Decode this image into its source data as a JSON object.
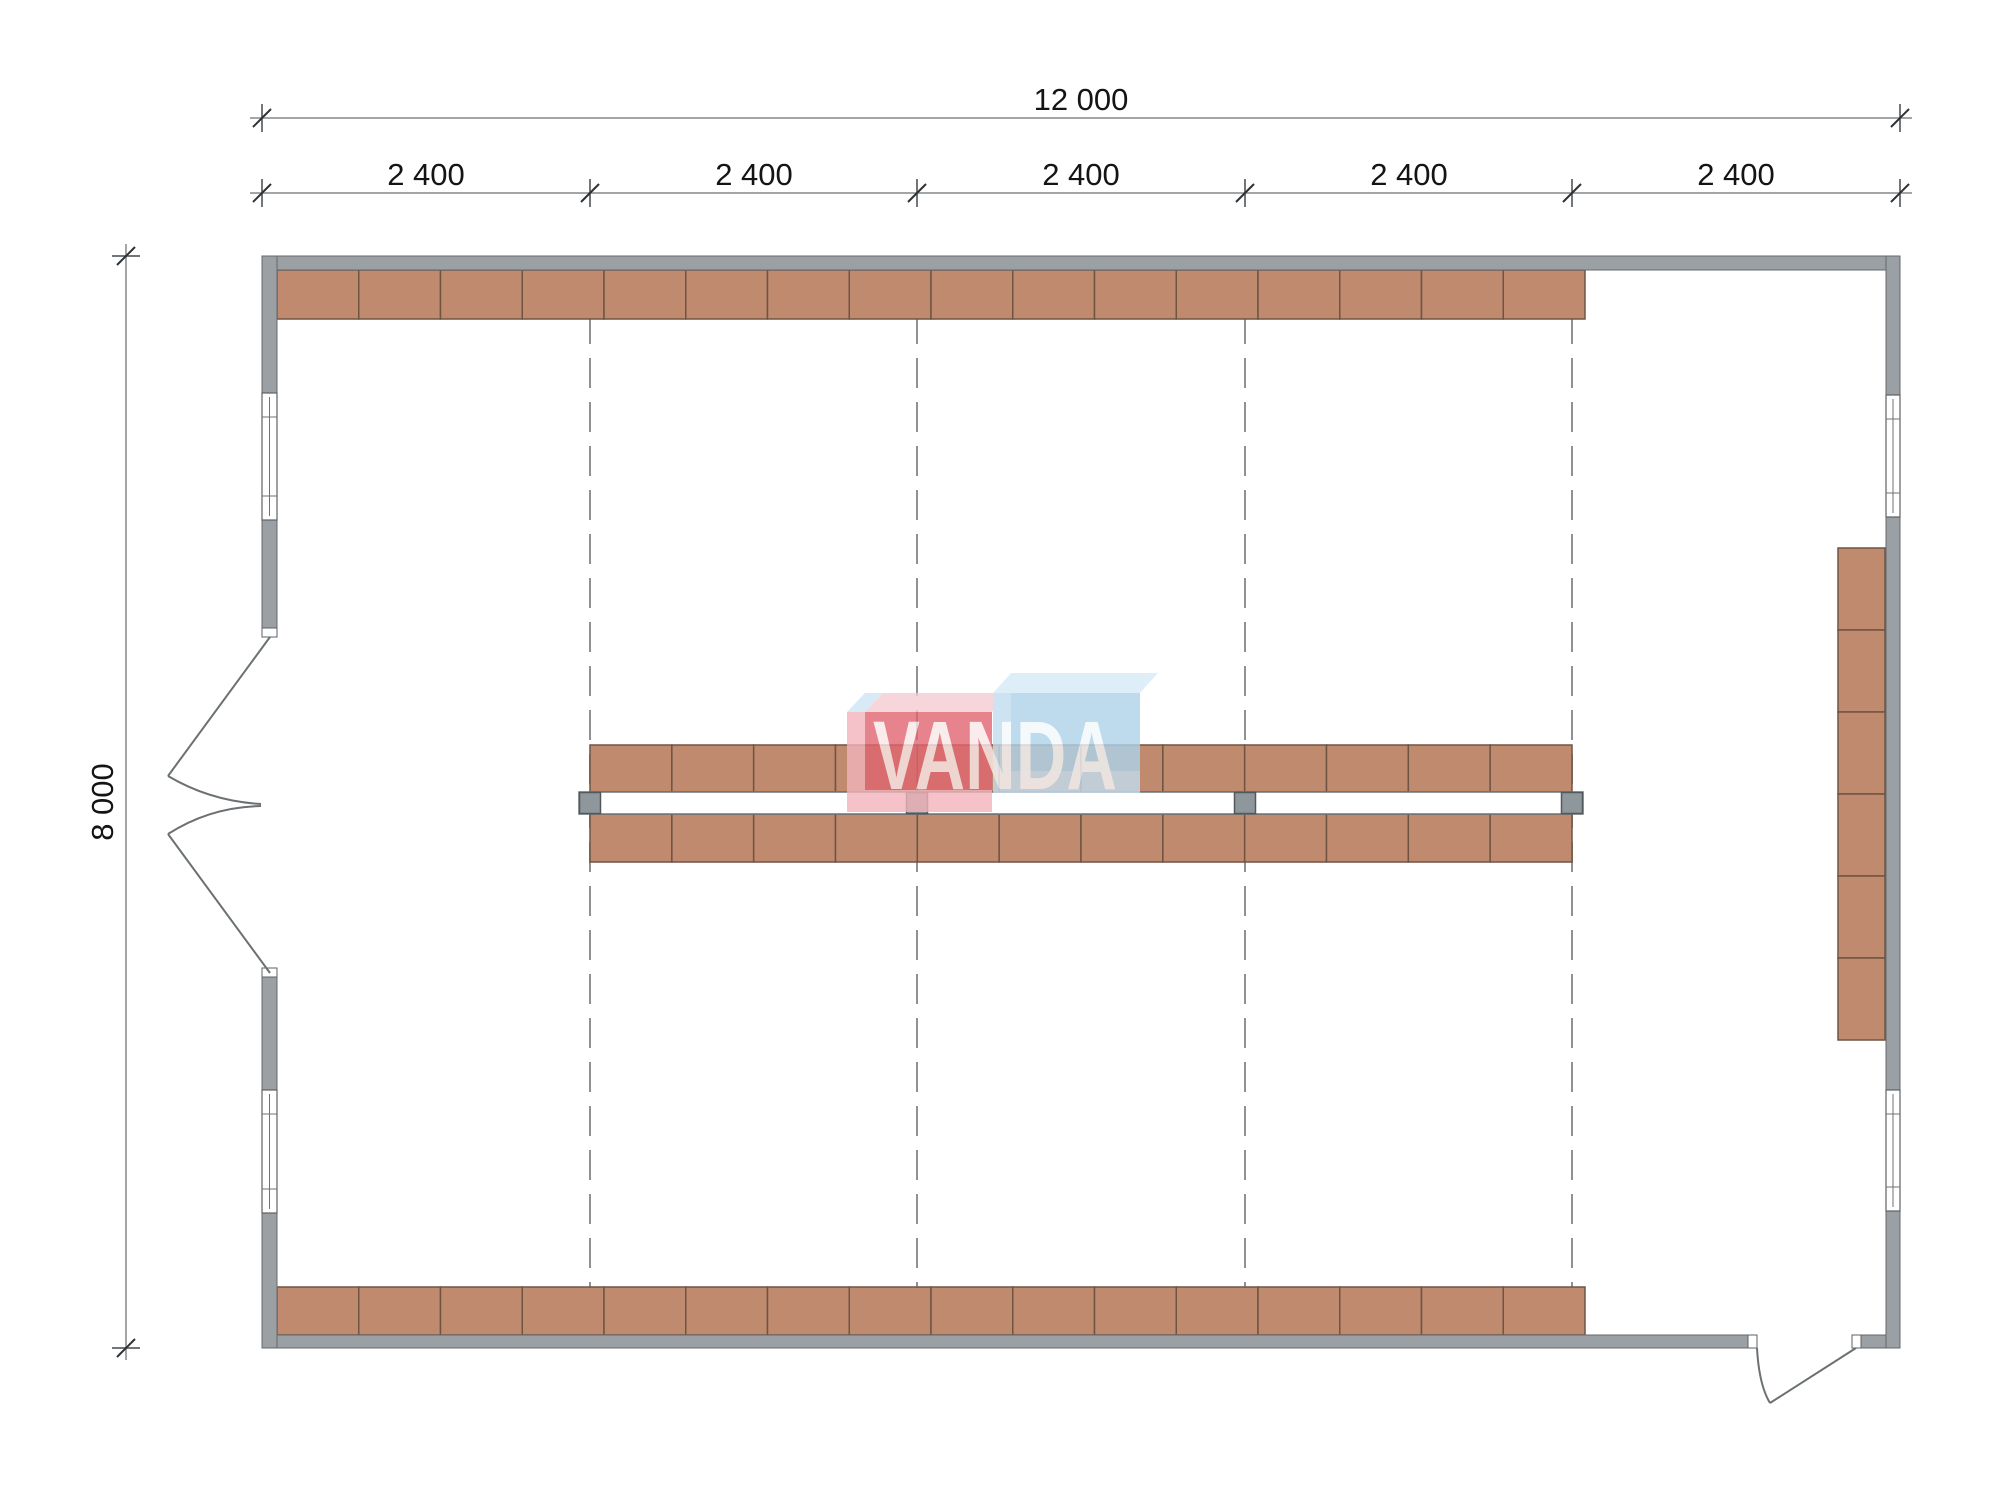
{
  "drawing": {
    "type": "warehouse-floor-plan",
    "dimensions": {
      "total_width_label": "12 000",
      "bay_labels": [
        "2 400",
        "2 400",
        "2 400",
        "2 400",
        "2 400"
      ],
      "total_height_label": "8 000"
    },
    "watermark": {
      "text": "VANDA",
      "red_cube": "#e06570",
      "red_cube_light": "#f2b4bb",
      "red_cube_top": "#f6ccd3",
      "blue_cube": "#aed3eb",
      "blue_cube_light": "#c3ddef",
      "blue_cube_top": "#d7eaf7",
      "text_color": "#ffffff"
    },
    "colors": {
      "wall": "#9aa0a4",
      "wall_stroke": "#65696c",
      "shelf": "#c08a6f",
      "shelf_stroke": "#6f5444",
      "column": "#8e979b",
      "dash": "#8f9294",
      "dim_line": "#84888b",
      "dim_text": "#141414",
      "door_line": "#6b7073"
    },
    "shelving": {
      "top_row_cells": 16,
      "bottom_row_cells": 16,
      "center_top_cells": 12,
      "center_bottom_cells": 12,
      "right_stack_cells": 6,
      "center_columns": 4,
      "grid_lines": 4
    }
  }
}
